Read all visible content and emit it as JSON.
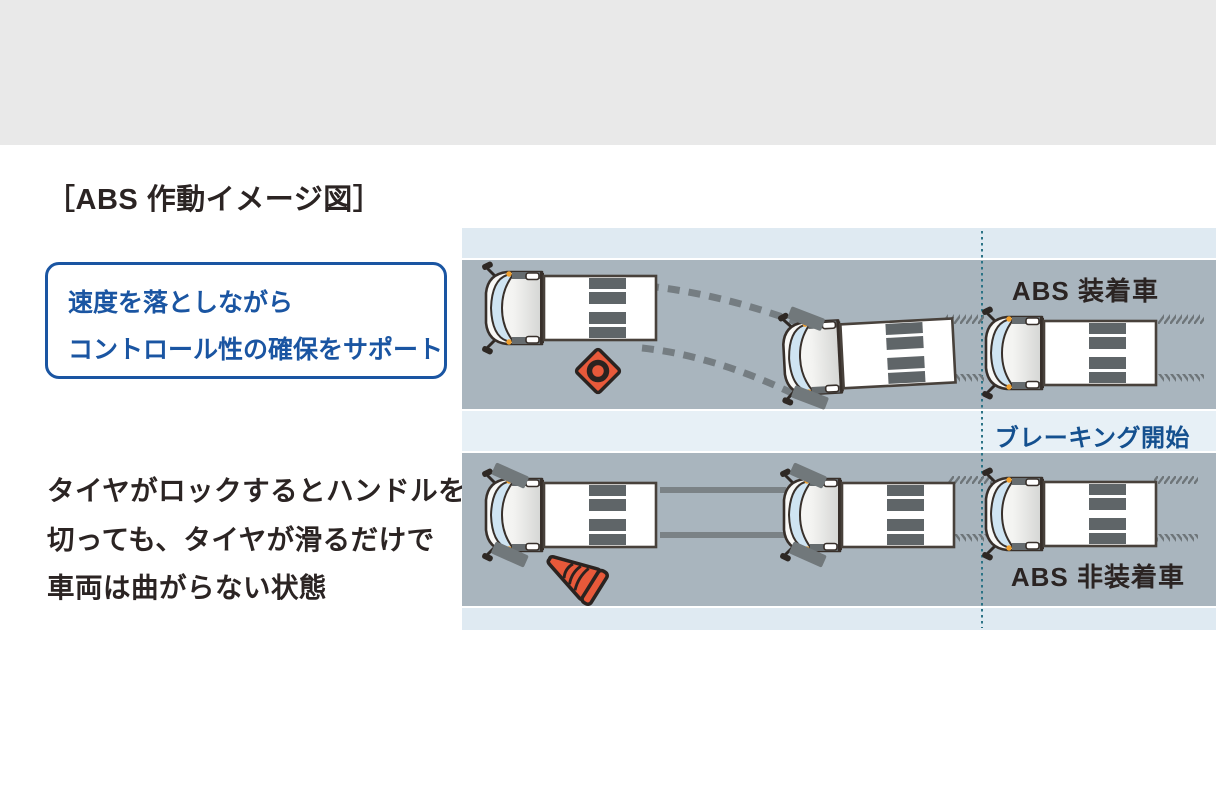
{
  "title": "［ABS 作動イメージ図］",
  "callout": {
    "lines": [
      "速度を落としながら",
      "コントロール性の確保をサポート"
    ]
  },
  "description": {
    "lines": [
      "タイヤがロックするとハンドルを",
      "切っても、タイヤが滑るだけで",
      "車両は曲がらない状態"
    ]
  },
  "diagram": {
    "top_label": "ABS 装着車",
    "middle_label": "ブレーキング開始",
    "bottom_label": "ABS 非装着車",
    "icons": [
      "truck-top-view",
      "hazard-marker-icon",
      "traffic-cone-icon",
      "skid-dashes-curved",
      "skid-lines-straight",
      "braking-start-dotted-line"
    ],
    "colors": {
      "top_band": "#e9e9e9",
      "road_gray": "#a9b5be",
      "edge_strip_blue": "#dfeaf2",
      "mid_strip_blue": "#e7f0f6",
      "dotted_line_teal": "#2b7386",
      "accent_blue": "#1a55a2",
      "braking_text_blue": "#14508f",
      "text_dark": "#2b2423",
      "obstacle_orange": "#e8593a",
      "marker_light_orange": "#f2a12e",
      "skid_gray": "#757d82"
    }
  }
}
